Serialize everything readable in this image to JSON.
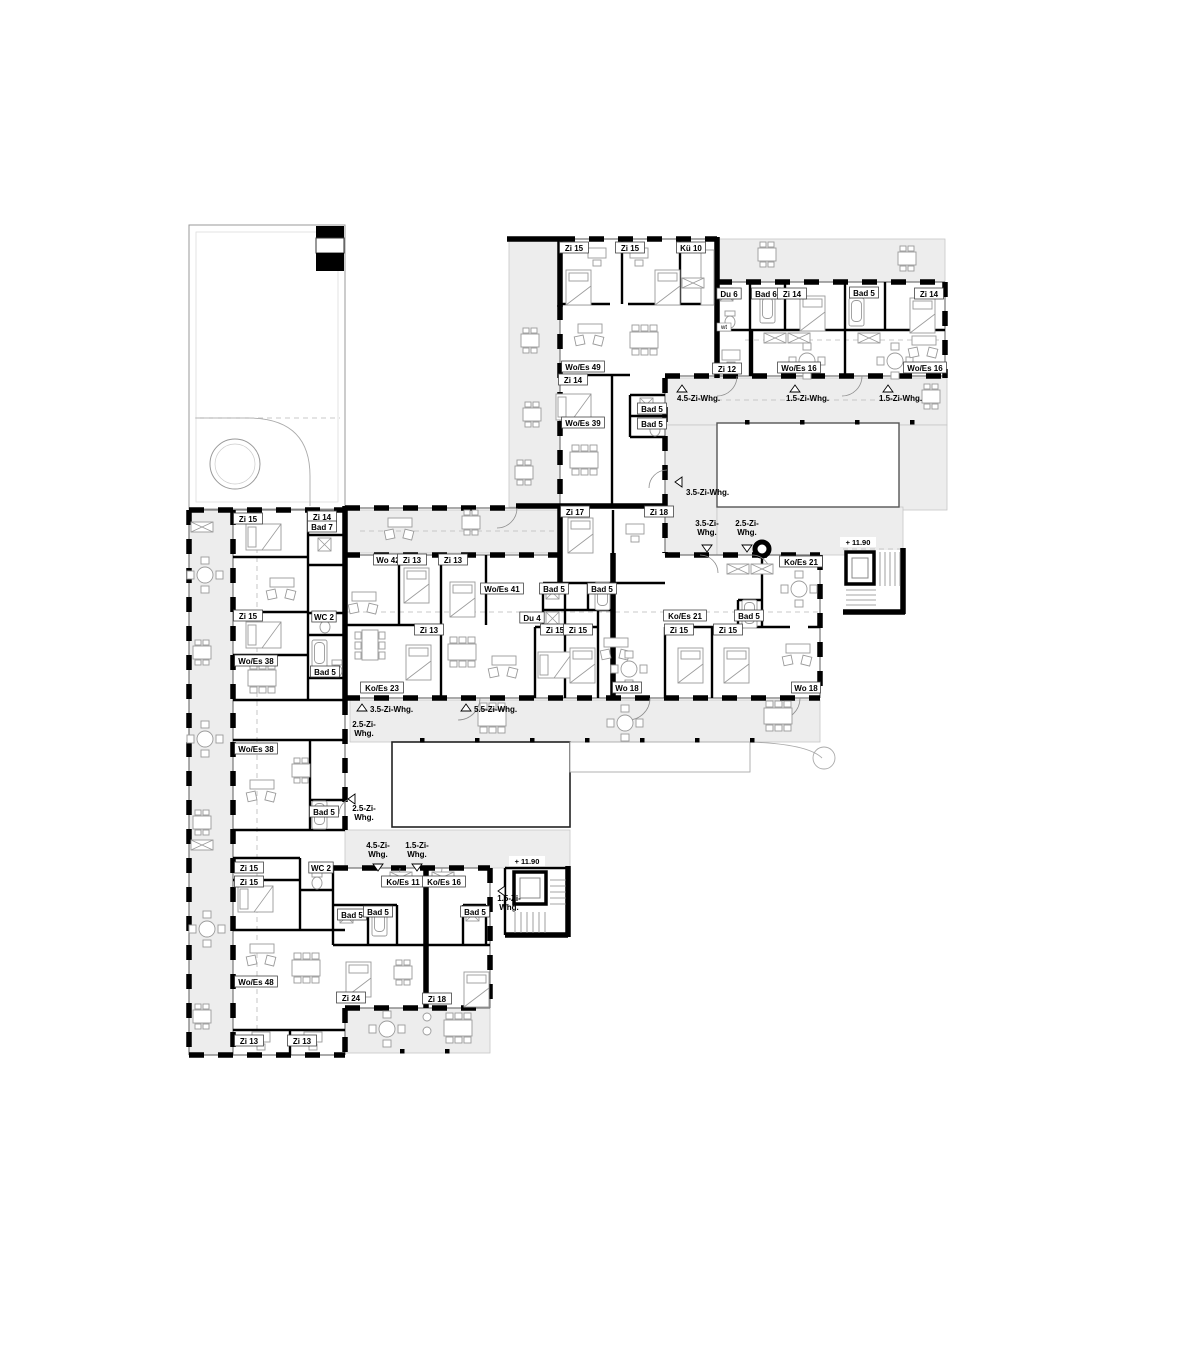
{
  "drawing": {
    "kind": "floor-plan",
    "colors": {
      "wall": "#000000",
      "terrace": "#ededed",
      "furniture": "#9a9a9a",
      "label_border": "#444444",
      "paper": "#ffffff"
    }
  },
  "room_labels": [
    {
      "text": "Zi 15",
      "x": 574,
      "y": 250
    },
    {
      "text": "Zi 15",
      "x": 630,
      "y": 250
    },
    {
      "text": "Kü 10",
      "x": 691,
      "y": 250
    },
    {
      "text": "Du 6",
      "x": 729,
      "y": 296
    },
    {
      "text": "Bad 6",
      "x": 766,
      "y": 296
    },
    {
      "text": "Zi 14",
      "x": 792,
      "y": 296
    },
    {
      "text": "Bad 5",
      "x": 864,
      "y": 295
    },
    {
      "text": "Zi 14",
      "x": 929,
      "y": 296
    },
    {
      "text": "Zi 12",
      "x": 727,
      "y": 371
    },
    {
      "text": "Wo/Es 16",
      "x": 799,
      "y": 370
    },
    {
      "text": "Wo/Es 16",
      "x": 925,
      "y": 370
    },
    {
      "text": "Wo/Es 49",
      "x": 583,
      "y": 369
    },
    {
      "text": "Zi 14",
      "x": 573,
      "y": 382
    },
    {
      "text": "Bad 5",
      "x": 652,
      "y": 411
    },
    {
      "text": "Bad 5",
      "x": 652,
      "y": 426
    },
    {
      "text": "Wo/Es 39",
      "x": 583,
      "y": 425
    },
    {
      "text": "Zi 17",
      "x": 575,
      "y": 514
    },
    {
      "text": "Zi 18",
      "x": 659,
      "y": 514
    },
    {
      "text": "Zi 15",
      "x": 248,
      "y": 521
    },
    {
      "text": "Zi 14",
      "x": 322,
      "y": 519
    },
    {
      "text": "Bad 7",
      "x": 322,
      "y": 529
    },
    {
      "text": "Wo 42",
      "x": 388,
      "y": 562
    },
    {
      "text": "Zi 13",
      "x": 412,
      "y": 562
    },
    {
      "text": "Zi 13",
      "x": 453,
      "y": 562
    },
    {
      "text": "Wo/Es 41",
      "x": 502,
      "y": 591
    },
    {
      "text": "Bad 5",
      "x": 554,
      "y": 591
    },
    {
      "text": "Bad 5",
      "x": 602,
      "y": 591
    },
    {
      "text": "Ko/Es 21",
      "x": 801,
      "y": 564
    },
    {
      "text": "Du 4",
      "x": 532,
      "y": 620
    },
    {
      "text": "Ko/Es 21",
      "x": 685,
      "y": 618
    },
    {
      "text": "Bad 5",
      "x": 749,
      "y": 618
    },
    {
      "text": "Zi 15",
      "x": 248,
      "y": 618
    },
    {
      "text": "WC 2",
      "x": 324,
      "y": 619
    },
    {
      "text": "Zi 15",
      "x": 555,
      "y": 632
    },
    {
      "text": "Zi 15",
      "x": 578,
      "y": 632
    },
    {
      "text": "Zi 15",
      "x": 679,
      "y": 632
    },
    {
      "text": "Zi 15",
      "x": 728,
      "y": 632
    },
    {
      "text": "Zi 13",
      "x": 429,
      "y": 632
    },
    {
      "text": "Wo/Es 38",
      "x": 256,
      "y": 663
    },
    {
      "text": "Bad 5",
      "x": 325,
      "y": 674
    },
    {
      "text": "Ko/Es 23",
      "x": 382,
      "y": 690
    },
    {
      "text": "Wo 18",
      "x": 627,
      "y": 690
    },
    {
      "text": "Wo 18",
      "x": 806,
      "y": 690
    },
    {
      "text": "Wo/Es 38",
      "x": 256,
      "y": 751
    },
    {
      "text": "Bad 5",
      "x": 324,
      "y": 814
    },
    {
      "text": "Zi 15",
      "x": 249,
      "y": 870
    },
    {
      "text": "WC 2",
      "x": 321,
      "y": 870
    },
    {
      "text": "Zi 15",
      "x": 249,
      "y": 884
    },
    {
      "text": "Ko/Es 11",
      "x": 403,
      "y": 884
    },
    {
      "text": "Ko/Es 16",
      "x": 444,
      "y": 884
    },
    {
      "text": "Bad 5",
      "x": 352,
      "y": 917
    },
    {
      "text": "Bad 5",
      "x": 378,
      "y": 914
    },
    {
      "text": "Bad 5",
      "x": 475,
      "y": 914
    },
    {
      "text": "Wo/Es 48",
      "x": 256,
      "y": 984
    },
    {
      "text": "Zi 24",
      "x": 351,
      "y": 1000
    },
    {
      "text": "Zi 18",
      "x": 437,
      "y": 1001
    },
    {
      "text": "Zi 13",
      "x": 249,
      "y": 1043
    },
    {
      "text": "Zi 13",
      "x": 302,
      "y": 1043
    }
  ],
  "small_labels": [
    {
      "text": "wt",
      "x": 724,
      "y": 329
    }
  ],
  "apartment_markers": [
    {
      "text": "4.5-Zi-Whg.",
      "x": 677,
      "y": 401,
      "anchor": "start",
      "tri": {
        "x": 682,
        "y": 389,
        "dir": "up"
      }
    },
    {
      "text": "1.5-Zi-Whg.",
      "x": 786,
      "y": 401,
      "anchor": "start",
      "tri": {
        "x": 795,
        "y": 389,
        "dir": "up"
      }
    },
    {
      "text": "1.5-Zi-Whg.",
      "x": 879,
      "y": 401,
      "anchor": "start",
      "tri": {
        "x": 888,
        "y": 389,
        "dir": "up"
      }
    },
    {
      "text": "3.5-Zi-Whg.",
      "x": 686,
      "y": 495,
      "anchor": "start",
      "tri": {
        "x": 679,
        "y": 482,
        "dir": "left"
      }
    },
    {
      "text": "3.5-Zi-\nWhg.",
      "x": 707,
      "y": 526,
      "anchor": "middle",
      "tri": {
        "x": 707,
        "y": 548,
        "dir": "down"
      }
    },
    {
      "text": "2.5-Zi-\nWhg.",
      "x": 747,
      "y": 526,
      "anchor": "middle",
      "tri": {
        "x": 747,
        "y": 548,
        "dir": "down"
      }
    },
    {
      "text": "3.5-Zi-Whg.",
      "x": 370,
      "y": 712,
      "anchor": "start",
      "tri": {
        "x": 362,
        "y": 708,
        "dir": "up"
      }
    },
    {
      "text": "5.5-Zi-Whg.",
      "x": 474,
      "y": 712,
      "anchor": "start",
      "tri": {
        "x": 466,
        "y": 708,
        "dir": "up"
      }
    },
    {
      "text": "2.5-Zi-\nWhg.",
      "x": 364,
      "y": 727,
      "anchor": "middle",
      "tri": null
    },
    {
      "text": "2.5-Zi-\nWhg.",
      "x": 364,
      "y": 811,
      "anchor": "middle",
      "tri": {
        "x": 352,
        "y": 799,
        "dir": "left"
      }
    },
    {
      "text": "4.5-Zi-\nWhg.",
      "x": 378,
      "y": 848,
      "anchor": "middle",
      "tri": {
        "x": 378,
        "y": 867,
        "dir": "down"
      }
    },
    {
      "text": "1.5-Zi-\nWhg.",
      "x": 417,
      "y": 848,
      "anchor": "middle",
      "tri": {
        "x": 417,
        "y": 867,
        "dir": "down"
      }
    },
    {
      "text": "1.5-Zi-\nWhg.",
      "x": 509,
      "y": 901,
      "anchor": "middle",
      "tri": {
        "x": 502,
        "y": 891,
        "dir": "left"
      }
    }
  ],
  "level_markers": [
    {
      "text": "+ 11.90",
      "x": 858,
      "y": 545
    },
    {
      "text": "+ 11.90",
      "x": 527,
      "y": 864
    }
  ]
}
